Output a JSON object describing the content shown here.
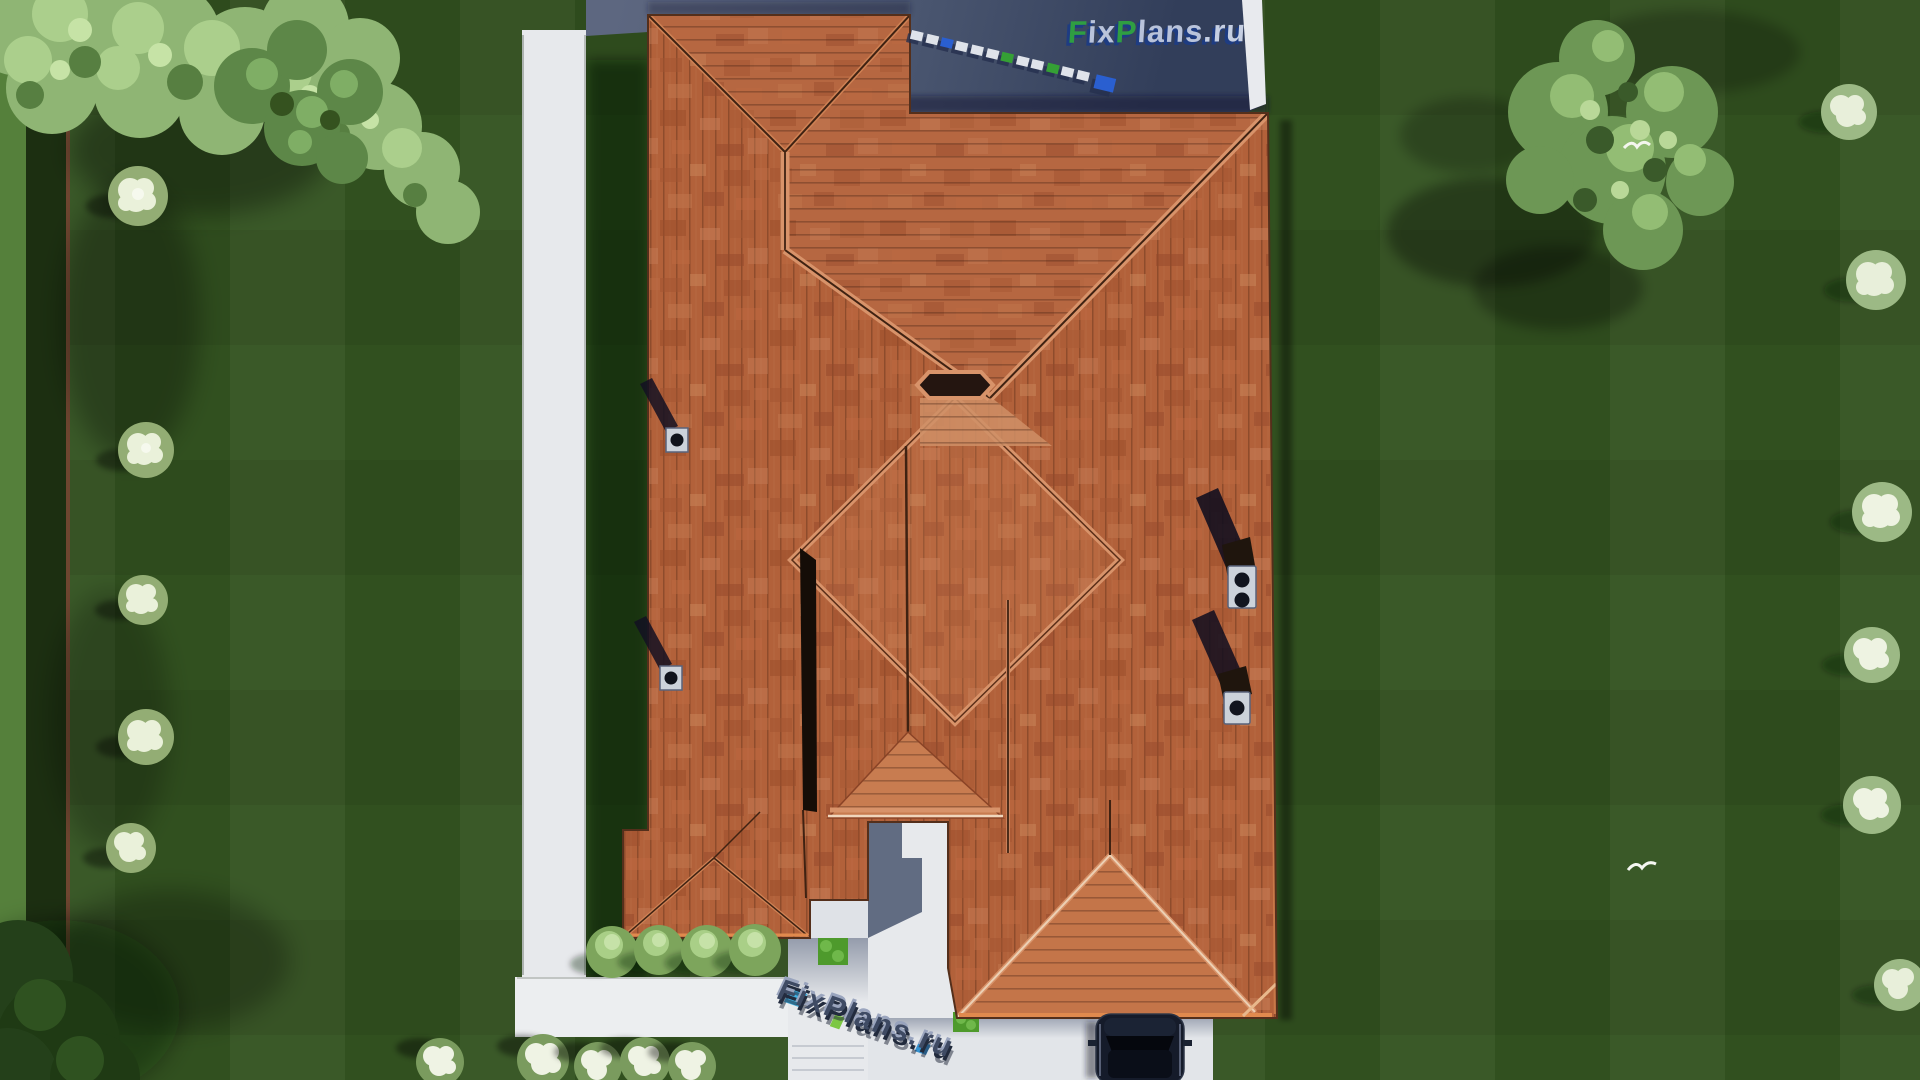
{
  "brand": {
    "logo_top": {
      "full_text": "FixPlans.ru",
      "seg_f": "F",
      "seg_ix": "ix",
      "seg_p": "P",
      "seg_lans": "lans",
      "seg_ru": ".ru",
      "green": "#2f9e42",
      "lavender": "#b9c3da",
      "shadow_navy": "#1e3c82"
    },
    "watermark_bottom": {
      "text": "FixPlans.ru",
      "navy": "#39455f",
      "cyan": "#3cb1e4",
      "green_accent": "#78c63e"
    },
    "watermark_driveway": {
      "text": "FixPlans.ru"
    }
  },
  "palette": {
    "grass": "#31501f",
    "grass_shadow": "#1e3512",
    "hedge": "#1c2f11",
    "fence": "#6e4630",
    "path_white": "#e7e9ec",
    "driveway": "#55607a",
    "driveway_shadow": "#323e5a",
    "roof_base": "#b2613a",
    "roof_dark": "#9a4c2a",
    "roof_light": "#c8805a",
    "ridge_highlight": "#d8936a",
    "eave_highlight": "#e08a4e",
    "chimney_cap": "#ccd2da",
    "car_body": "#141b2a",
    "tree_light": "#8fb574",
    "tree_dark": "#5d8748",
    "flower_white": "#eaf1da"
  }
}
